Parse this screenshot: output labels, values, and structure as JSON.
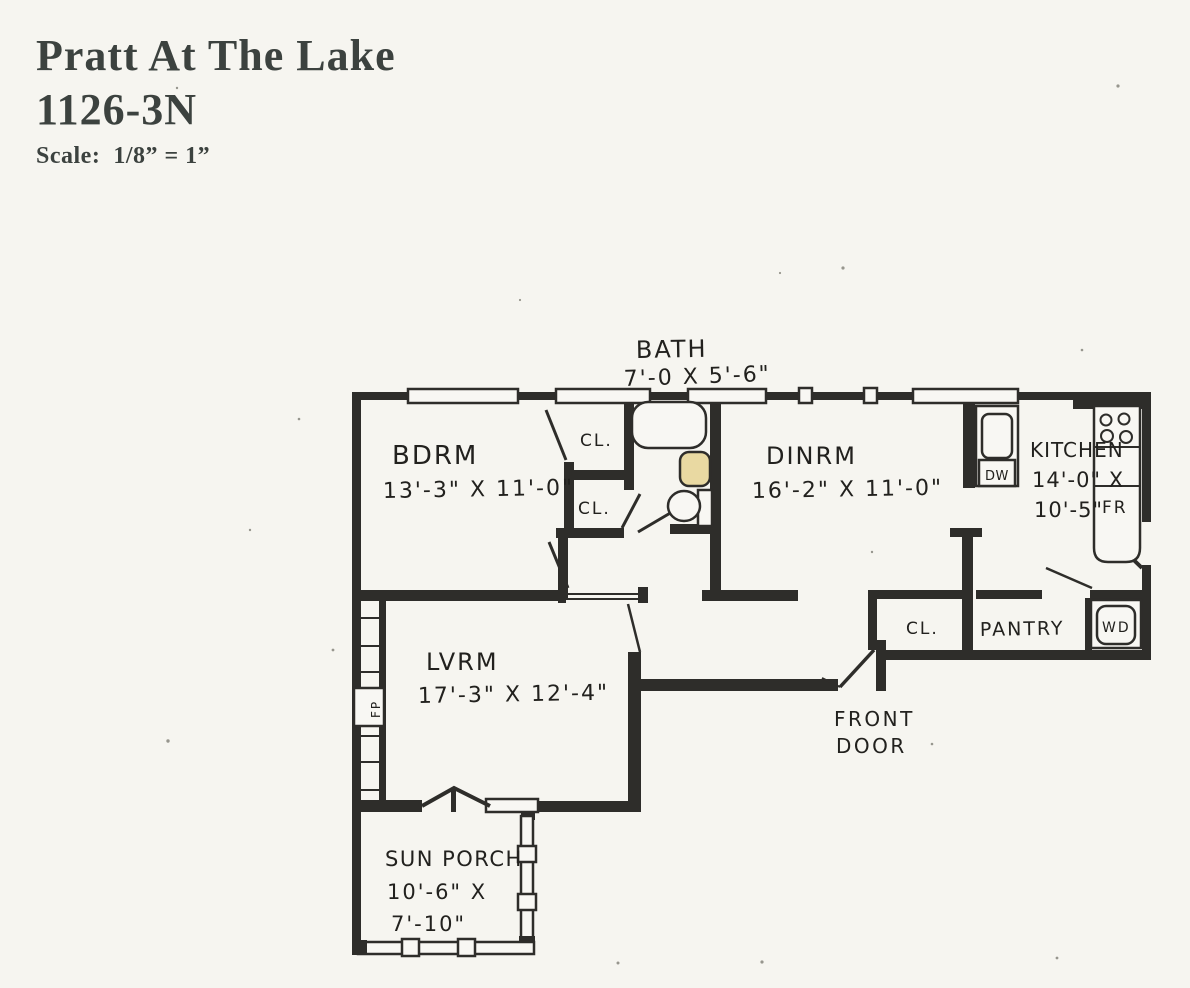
{
  "colors": {
    "paper": "#f6f5f0",
    "ink": "#2e2d2a",
    "title_ink": "#3c423f",
    "sink_tint": "#e9d9a2"
  },
  "title": {
    "line1": "Pratt At The Lake",
    "line2": "1126-3N",
    "scale": "Scale:  1/8” = 1”"
  },
  "plan": {
    "bath": {
      "label": "BATH",
      "dims": "7'-0 X 5'-6\""
    },
    "bdrm": {
      "label": "BDRM",
      "dims": "13'-3\" X 11'-0\""
    },
    "dinrm": {
      "label": "DINRM",
      "dims": "16'-2\" X 11'-0\""
    },
    "kitchen": {
      "label": "KITCHEN",
      "dims1": "14'-0\" X",
      "dims2": "10'-5\""
    },
    "lvrm": {
      "label": "LVRM",
      "dims": "17'-3\" X 12'-4\""
    },
    "sun_porch": {
      "label": "SUN PORCH",
      "dims1": "10'-6\" X",
      "dims2": "7'-10\""
    },
    "closet_bdrm_upper": "CL.",
    "closet_bdrm_lower": "CL.",
    "closet_entry": "CL.",
    "pantry": "PANTRY",
    "front_door_line1": "FRONT",
    "front_door_line2": "DOOR",
    "fixtures": {
      "dishwasher": "DW",
      "fridge": "FR",
      "washer_dryer": "WD",
      "fireplace": "FP"
    }
  }
}
